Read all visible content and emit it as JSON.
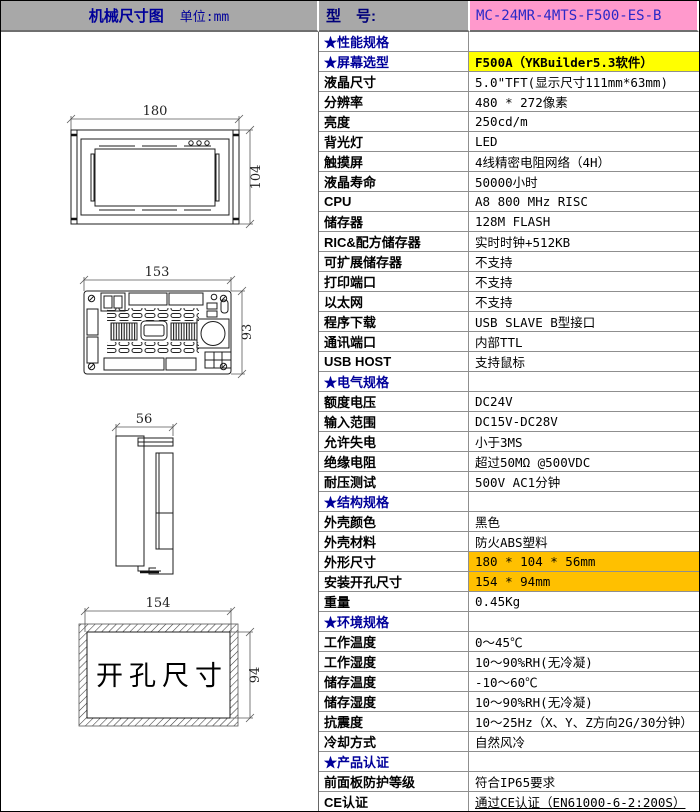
{
  "header": {
    "title": "机械尺寸图",
    "unit": "单位:mm",
    "model_label": "型　号:",
    "model_value": "MC-24MR-4MTS-F500-ES-B"
  },
  "colors": {
    "header_bg": "#a8a8a8",
    "model_bg": "#ff99cc",
    "model_text": "#2929c8",
    "section_text": "#00009a",
    "yellow_highlight": "#ffff00",
    "orange_highlight": "#ffc000",
    "grid_line": "#8f8f8f"
  },
  "diagrams": {
    "front": {
      "width_label": "180",
      "height_label": "104"
    },
    "rear": {
      "width_label": "153",
      "height_label": "93"
    },
    "side": {
      "width_label": "56"
    },
    "cutout": {
      "caption": "开孔尺寸",
      "width_label": "154",
      "height_label": "94"
    }
  },
  "spec_rows": [
    {
      "label": "★性能规格",
      "value": "",
      "section": true
    },
    {
      "label": "★屏幕选型",
      "value": "F500A（YKBuilder5.3软件）",
      "section": true,
      "highlight": "yellow",
      "bold": true
    },
    {
      "label": "液晶尺寸",
      "value": "5.0\"TFT(显示尺寸111mm*63mm)"
    },
    {
      "label": "分辨率",
      "value": "480 * 272像素"
    },
    {
      "label": "亮度",
      "value": "250cd/m"
    },
    {
      "label": "背光灯",
      "value": "LED"
    },
    {
      "label": "触摸屏",
      "value": "4线精密电阻网络（4H）"
    },
    {
      "label": "液晶寿命",
      "value": "50000小时"
    },
    {
      "label": "CPU",
      "value": "A8 800 MHz RISC"
    },
    {
      "label": "储存器",
      "value": "128M FLASH"
    },
    {
      "label": "RIC&配方储存器",
      "value": "实时时钟+512KB"
    },
    {
      "label": "可扩展储存器",
      "value": "不支持"
    },
    {
      "label": "打印端口",
      "value": "不支持"
    },
    {
      "label": "以太网",
      "value": "不支持"
    },
    {
      "label": "程序下载",
      "value": "USB SLAVE B型接口"
    },
    {
      "label": "通讯端口",
      "value": "内部TTL"
    },
    {
      "label": "USB HOST",
      "value": "支持鼠标"
    },
    {
      "label": "★电气规格",
      "value": "",
      "section": true
    },
    {
      "label": "额度电压",
      "value": "DC24V"
    },
    {
      "label": "输入范围",
      "value": "DC15V-DC28V"
    },
    {
      "label": "允许失电",
      "value": "小于3MS"
    },
    {
      "label": "绝缘电阻",
      "value": "超过50MΩ @500VDC"
    },
    {
      "label": "耐压测试",
      "value": "500V AC1分钟"
    },
    {
      "label": "★结构规格",
      "value": "",
      "section": true
    },
    {
      "label": "外壳颜色",
      "value": "黑色"
    },
    {
      "label": "外壳材料",
      "value": "防火ABS塑料"
    },
    {
      "label": "外形尺寸",
      "value": "180 * 104 * 56mm",
      "highlight": "orange"
    },
    {
      "label": "安装开孔尺寸",
      "value": "154 * 94mm",
      "highlight": "orange"
    },
    {
      "label": "重量",
      "value": "0.45Kg"
    },
    {
      "label": "★环境规格",
      "value": "",
      "section": true
    },
    {
      "label": "工作温度",
      "value": "0～45℃"
    },
    {
      "label": "工作湿度",
      "value": "10～90%RH(无冷凝)"
    },
    {
      "label": "储存温度",
      "value": "-10～60℃"
    },
    {
      "label": "储存湿度",
      "value": "10～90%RH(无冷凝)"
    },
    {
      "label": "抗震度",
      "value": "10～25Hz（X、Y、Z方向2G/30分钟）"
    },
    {
      "label": "冷却方式",
      "value": "自然风冷"
    },
    {
      "label": "★产品认证",
      "value": "",
      "section": true
    },
    {
      "label": "前面板防护等级",
      "value": "符合IP65要求"
    },
    {
      "label": "CE认证",
      "value": "通过CE认证（EN61000-6-2:200S）",
      "underline": true
    }
  ]
}
